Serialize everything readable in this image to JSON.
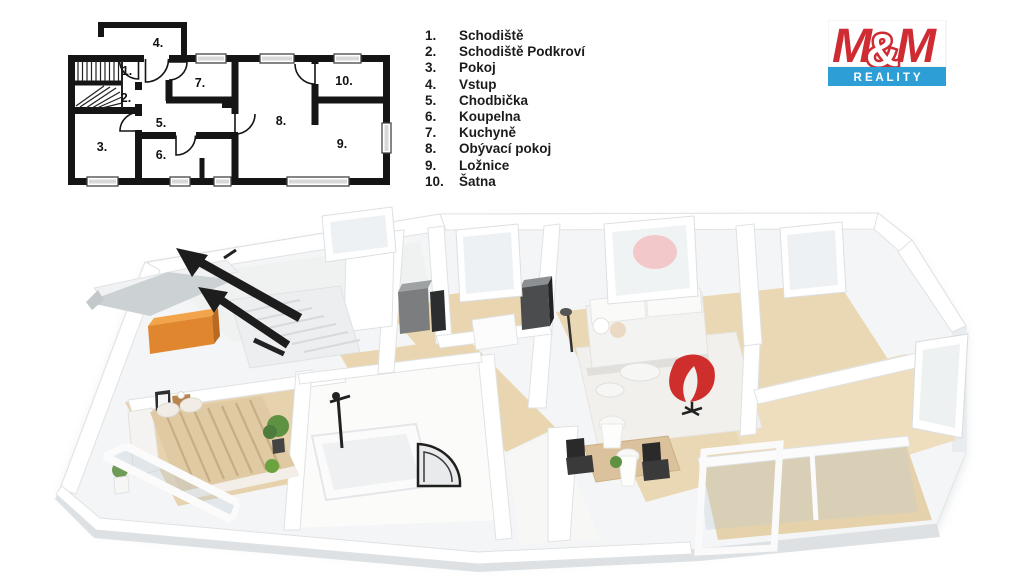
{
  "legend": {
    "items": [
      {
        "num": "1.",
        "label": "Schodiště"
      },
      {
        "num": "2.",
        "label": "Schodiště Podkroví"
      },
      {
        "num": "3.",
        "label": "Pokoj"
      },
      {
        "num": "4.",
        "label": "Vstup"
      },
      {
        "num": "5.",
        "label": "Chodbička"
      },
      {
        "num": "6.",
        "label": "Koupelna"
      },
      {
        "num": "7.",
        "label": "Kuchyně"
      },
      {
        "num": "8.",
        "label": "Obývací pokoj"
      },
      {
        "num": "9.",
        "label": "Ložnice"
      },
      {
        "num": "10.",
        "label": "Šatna"
      }
    ]
  },
  "logo": {
    "m_left": "M",
    "amp": "&",
    "m_right": "M",
    "reality": "R E A L I T Y",
    "red": "#cf2b33",
    "blue": "#2e9fd6"
  },
  "plan2d": {
    "wall_color": "#151515",
    "rooms": [
      {
        "num": "1.",
        "name": "Schodiště"
      },
      {
        "num": "2.",
        "name": "Schodiště Podkroví"
      },
      {
        "num": "3.",
        "name": "Pokoj"
      },
      {
        "num": "4.",
        "name": "Vstup"
      },
      {
        "num": "5.",
        "name": "Chodbička"
      },
      {
        "num": "6.",
        "name": "Koupelna"
      },
      {
        "num": "7.",
        "name": "Kuchyně"
      },
      {
        "num": "8.",
        "name": "Obývací pokoj"
      },
      {
        "num": "9.",
        "name": "Ložnice"
      },
      {
        "num": "10.",
        "name": "Šatna"
      }
    ]
  },
  "scene3d": {
    "colors": {
      "slab": "#f4f5f6",
      "wall": "#ffffff",
      "wall_edge": "#e1e4e6",
      "side_face": "#dde1e4",
      "wood_floor": "#e9d6b0",
      "rug": "#f1f0ec",
      "red_chair": "#cf2f2c",
      "orange_wardrobe": "#e0862e",
      "stair_arrow": "#1d1d1d",
      "plant": "#5e9141",
      "kitchen_unit_dark": "#4a4c4e",
      "kitchen_unit_gray": "#7b7d7e",
      "glass": "#dfe8ec"
    }
  }
}
